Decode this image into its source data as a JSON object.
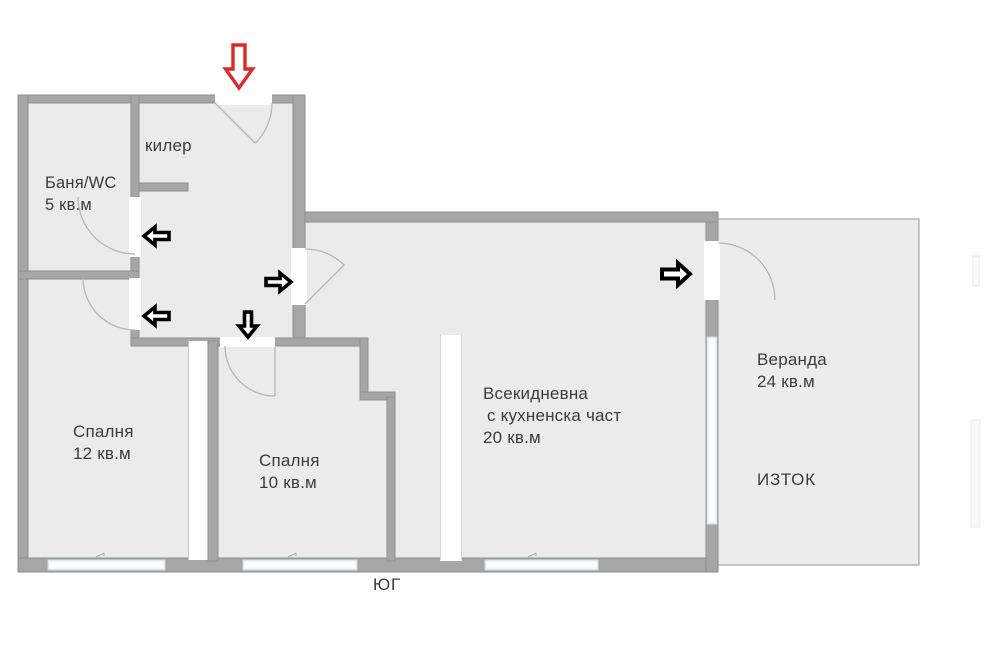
{
  "plan": {
    "rooms": {
      "pantry": {
        "name": "килер"
      },
      "bathroom": {
        "name": "Баня/WC",
        "area": "5 кв.м"
      },
      "bedroom_large": {
        "name": "Спалня",
        "area": "12 кв.м"
      },
      "bedroom_small": {
        "name": "Спалня",
        "area": "10 кв.м"
      },
      "living": {
        "name_line1": "Всекидневна",
        "name_line2": "с кухненска част",
        "area": "20 кв.м"
      },
      "veranda": {
        "name": "Веранда",
        "area": "24 кв.м"
      }
    },
    "compass": {
      "south": "ЮГ",
      "east": "ИЗТОК"
    },
    "arrows": {
      "entrance": {
        "direction": "down",
        "style": "outline",
        "color": "#d92b2b"
      },
      "interior": [
        {
          "id": "hall-upper-left",
          "direction": "left"
        },
        {
          "id": "hall-lower-left",
          "direction": "left"
        },
        {
          "id": "hall-to-living",
          "direction": "right"
        },
        {
          "id": "hall-down",
          "direction": "down"
        },
        {
          "id": "living-to-veranda",
          "direction": "right"
        }
      ],
      "interior_color": "#000000"
    },
    "colors": {
      "wall": "#a6a6a6",
      "wall_edge": "#8f8f8f",
      "room_fill": "#ebebeb",
      "veranda_fill": "#ececec",
      "window_glass": "#eef7f7",
      "window_frame": "#c7dde0",
      "door_arc": "#b6b6b6",
      "text": "#3b3b3b"
    }
  }
}
